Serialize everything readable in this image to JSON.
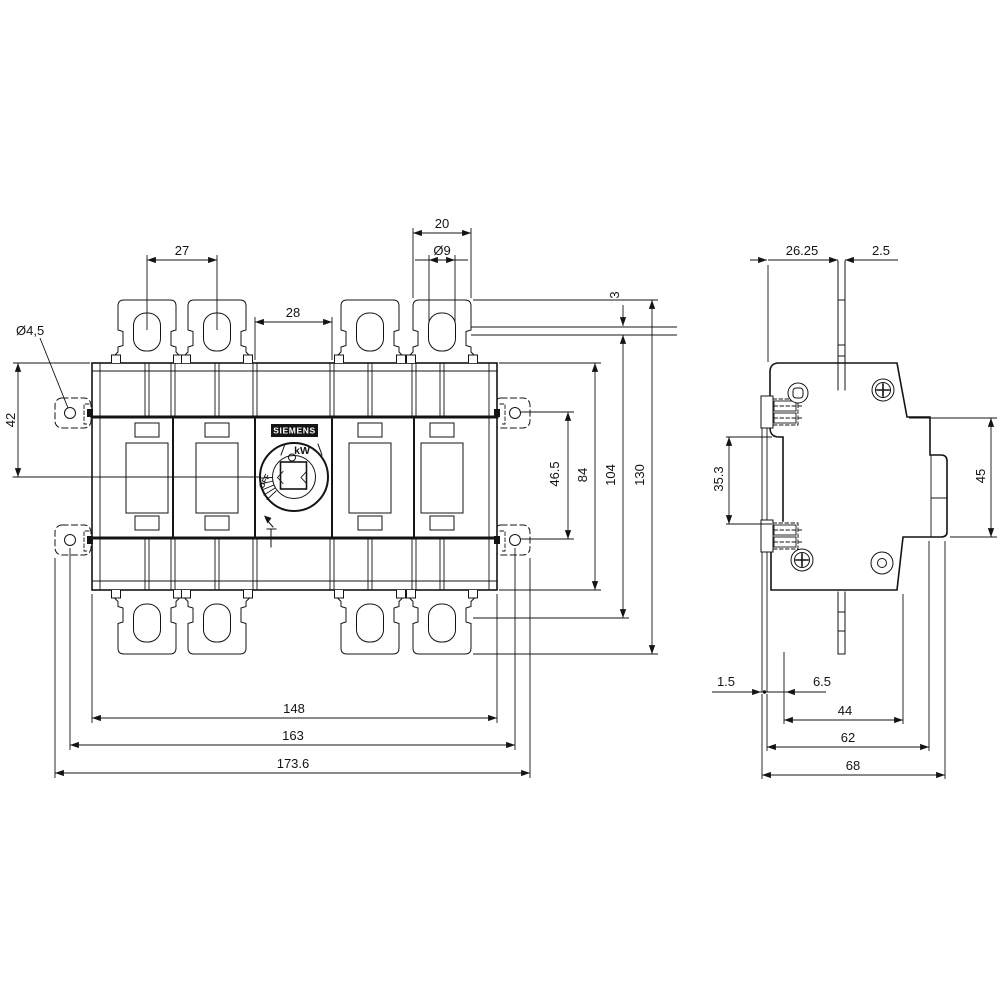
{
  "drawing_type": "switch-disconnector dimension drawing",
  "front_view": {
    "brand_label": "SIEMENS",
    "kw_label": "kW",
    "off_label": "OFF",
    "dims": {
      "lug_pitch": "27",
      "pole_width": "28",
      "lug_width": "20",
      "lug_hole": "Ø9",
      "mount_hole": "Ø4,5",
      "top_to_center": "42",
      "tab_thickness": "3",
      "tab_hole_spacing": "46.5",
      "body_height": "84",
      "over_lugs_height": "104",
      "total_height": "130",
      "body_width": "148",
      "mount_spacing": "163",
      "total_width": "173.6"
    }
  },
  "side_view": {
    "dims": {
      "shaft_offset": "26.25",
      "shaft_width": "2.5",
      "clamp_spacing": "35.3",
      "side_step_height": "45",
      "rail_lip": "1.5",
      "rail_depth": "6.5",
      "depth_inner": "44",
      "depth_body": "62",
      "depth_total": "68"
    }
  }
}
